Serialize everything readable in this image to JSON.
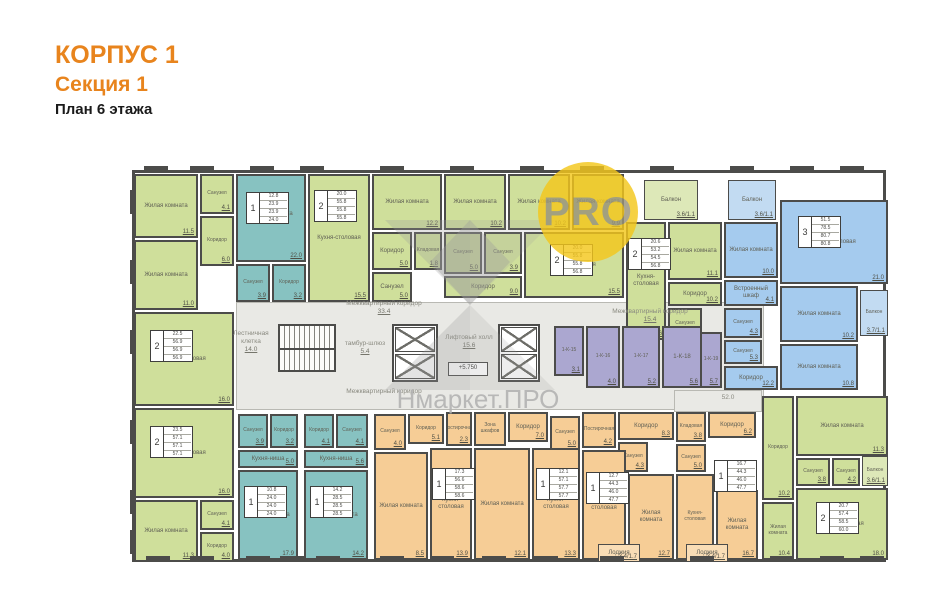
{
  "header": {
    "building": "КОРПУС 1",
    "section": "Секция 1",
    "floor": "План 6 этажа"
  },
  "watermark": {
    "brand": "Нмаркет.ПРО",
    "badge": "PRO"
  },
  "colors": {
    "accent": "#e8841d",
    "wall": "#4c4c4a",
    "green": "#cfdf9b",
    "teal": "#87c2c1",
    "blue": "#a5cbee",
    "orange": "#f6cd96",
    "purple": "#aba7d0",
    "corridor": "#e9e9e5",
    "badge_yellow": "#f4c71c"
  },
  "plan": {
    "corridor_zones": [
      {
        "x": 106,
        "y": 142,
        "w": 528,
        "h": 108
      },
      {
        "x": 544,
        "y": 230,
        "w": 88,
        "h": 22
      }
    ],
    "rooms": [
      {
        "n": "Жилая комната",
        "a": "11.5",
        "c": "g",
        "x": 4,
        "y": 14,
        "w": 64,
        "h": 64
      },
      {
        "n": "Санузел",
        "a": "4.1",
        "c": "g",
        "x": 70,
        "y": 14,
        "w": 34,
        "h": 40
      },
      {
        "n": "Коридор",
        "a": "6.0",
        "c": "g",
        "x": 70,
        "y": 56,
        "w": 34,
        "h": 50
      },
      {
        "n": "Жилая комната",
        "a": "11.0",
        "c": "g",
        "x": 4,
        "y": 80,
        "w": 64,
        "h": 70
      },
      {
        "n": "Кухня-столовая",
        "a": "16.0",
        "c": "g",
        "x": 4,
        "y": 152,
        "w": 100,
        "h": 94
      },
      {
        "n": "Кухня-столовая",
        "a": "16.0",
        "c": "g",
        "x": 4,
        "y": 248,
        "w": 100,
        "h": 90
      },
      {
        "n": "Жилая комната",
        "a": "11.3",
        "c": "g",
        "x": 4,
        "y": 340,
        "w": 64,
        "h": 62
      },
      {
        "n": "Санузел",
        "a": "4.1",
        "c": "g",
        "x": 70,
        "y": 340,
        "w": 34,
        "h": 30
      },
      {
        "n": "Коридор",
        "a": "4.0",
        "c": "g",
        "x": 70,
        "y": 372,
        "w": 34,
        "h": 30
      },
      {
        "n": "Жилая комната",
        "n2": "Кухня-ниша",
        "a": "22.0",
        "c": "t",
        "x": 106,
        "y": 14,
        "w": 70,
        "h": 88
      },
      {
        "n": "Санузел",
        "a": "3.9",
        "c": "t",
        "x": 106,
        "y": 104,
        "w": 34,
        "h": 38
      },
      {
        "n": "Коридор",
        "a": "3.2",
        "c": "t",
        "x": 142,
        "y": 104,
        "w": 34,
        "h": 38
      },
      {
        "n": "Кухня-столовая",
        "a": "15.5",
        "c": "g",
        "x": 178,
        "y": 14,
        "w": 62,
        "h": 128
      },
      {
        "n": "Жилая комната",
        "a": "12.2",
        "c": "g",
        "x": 242,
        "y": 14,
        "w": 70,
        "h": 56
      },
      {
        "n": "Коридор",
        "a": "5.0",
        "c": "g",
        "x": 242,
        "y": 72,
        "w": 40,
        "h": 38
      },
      {
        "n": "Кладовая",
        "a": "1.8",
        "c": "g",
        "x": 284,
        "y": 72,
        "w": 28,
        "h": 38
      },
      {
        "n": "Санузел",
        "a": "5.0",
        "c": "g",
        "x": 242,
        "y": 112,
        "w": 40,
        "h": 30
      },
      {
        "n": "Жилая комната",
        "a": "10.2",
        "c": "g",
        "x": 314,
        "y": 14,
        "w": 62,
        "h": 56
      },
      {
        "n": "Жилая комната",
        "a": "10.2",
        "c": "g",
        "x": 378,
        "y": 14,
        "w": 62,
        "h": 56
      },
      {
        "n": "Жилая комната",
        "a": "9.9",
        "c": "g",
        "x": 442,
        "y": 14,
        "w": 52,
        "h": 56
      },
      {
        "n": "Санузел",
        "a": "5.0",
        "c": "g",
        "x": 314,
        "y": 72,
        "w": 38,
        "h": 42
      },
      {
        "n": "Санузел",
        "a": "3.9",
        "c": "g",
        "x": 354,
        "y": 72,
        "w": 38,
        "h": 42
      },
      {
        "n": "Коридор",
        "a": "9.0",
        "c": "g",
        "x": 314,
        "y": 116,
        "w": 78,
        "h": 22
      },
      {
        "n": "Кухня-столовая",
        "a": "15.5",
        "c": "g",
        "x": 394,
        "y": 72,
        "w": 100,
        "h": 66
      },
      {
        "n": "Балкон",
        "a": "3.6/1.1",
        "c": "gb",
        "x": 514,
        "y": 20,
        "w": 54,
        "h": 40
      },
      {
        "n": "Кухня-столовая",
        "a": "18.6",
        "c": "g",
        "x": 496,
        "y": 62,
        "w": 40,
        "h": 118
      },
      {
        "n": "Жилая комната",
        "a": "11.1",
        "c": "g",
        "x": 538,
        "y": 62,
        "w": 54,
        "h": 58
      },
      {
        "n": "Коридор",
        "a": "10.2",
        "c": "g",
        "x": 538,
        "y": 122,
        "w": 54,
        "h": 24
      },
      {
        "n": "Санузел",
        "a": "4.7",
        "c": "g",
        "x": 538,
        "y": 148,
        "w": 34,
        "h": 32
      },
      {
        "n": "Балкон",
        "a": "3.6/1.1",
        "c": "bb",
        "x": 598,
        "y": 20,
        "w": 48,
        "h": 40
      },
      {
        "n": "Жилая комната",
        "a": "10.0",
        "c": "b",
        "x": 594,
        "y": 62,
        "w": 54,
        "h": 56
      },
      {
        "n": "Кухня-столовая",
        "a": "21.0",
        "c": "b",
        "x": 650,
        "y": 40,
        "w": 108,
        "h": 84
      },
      {
        "n": "Встроенный шкаф",
        "a": "4.1",
        "c": "b",
        "x": 594,
        "y": 120,
        "w": 54,
        "h": 26
      },
      {
        "n": "Санузел",
        "a": "4.3",
        "c": "b",
        "x": 594,
        "y": 148,
        "w": 38,
        "h": 30
      },
      {
        "n": "Санузел",
        "a": "5.3",
        "c": "b",
        "x": 594,
        "y": 180,
        "w": 38,
        "h": 24
      },
      {
        "n": "Коридор",
        "a": "12.2",
        "c": "b",
        "x": 594,
        "y": 206,
        "w": 54,
        "h": 24
      },
      {
        "n": "Жилая комната",
        "a": "10.2",
        "c": "b",
        "x": 650,
        "y": 126,
        "w": 78,
        "h": 56
      },
      {
        "n": "Балкон",
        "a": "3.7/1.1",
        "c": "bb",
        "x": 730,
        "y": 130,
        "w": 28,
        "h": 46
      },
      {
        "n": "Жилая комната",
        "a": "10.8",
        "c": "b",
        "x": 650,
        "y": 184,
        "w": 78,
        "h": 46
      },
      {
        "n": "1-К-15",
        "a": "3.1",
        "c": "p",
        "x": 424,
        "y": 166,
        "w": 30,
        "h": 50
      },
      {
        "n": "1-К-16",
        "a": "4.0",
        "c": "p",
        "x": 456,
        "y": 166,
        "w": 34,
        "h": 62
      },
      {
        "n": "1-К-17",
        "a": "5.2",
        "c": "p",
        "x": 492,
        "y": 166,
        "w": 38,
        "h": 62
      },
      {
        "n": "1-К-18",
        "a": "5.6",
        "c": "p",
        "x": 532,
        "y": 166,
        "w": 40,
        "h": 62
      },
      {
        "n": "1-К-19",
        "a": "5.7",
        "c": "p",
        "x": 570,
        "y": 172,
        "w": 22,
        "h": 56
      },
      {
        "n": "Санузел",
        "a": "3.9",
        "c": "t",
        "x": 108,
        "y": 254,
        "w": 30,
        "h": 34
      },
      {
        "n": "Коридор",
        "a": "3.2",
        "c": "t",
        "x": 140,
        "y": 254,
        "w": 28,
        "h": 34
      },
      {
        "n": "Кухня-ниша",
        "a": "5.0",
        "c": "t",
        "x": 108,
        "y": 290,
        "w": 60,
        "h": 18
      },
      {
        "n": "Жилая комната",
        "a": "17.9",
        "c": "t",
        "x": 108,
        "y": 310,
        "w": 60,
        "h": 90
      },
      {
        "n": "Коридор",
        "a": "4.1",
        "c": "t",
        "x": 174,
        "y": 254,
        "w": 30,
        "h": 34
      },
      {
        "n": "Санузел",
        "a": "4.1",
        "c": "t",
        "x": 206,
        "y": 254,
        "w": 32,
        "h": 34
      },
      {
        "n": "Кухня-ниша",
        "a": "5.6",
        "c": "t",
        "x": 174,
        "y": 290,
        "w": 64,
        "h": 18
      },
      {
        "n": "Жилая комната",
        "a": "14.2",
        "c": "t",
        "x": 174,
        "y": 310,
        "w": 64,
        "h": 90
      },
      {
        "n": "Санузел",
        "a": "4.0",
        "c": "o",
        "x": 244,
        "y": 254,
        "w": 32,
        "h": 36
      },
      {
        "n": "Коридор",
        "a": "5.1",
        "c": "o",
        "x": 278,
        "y": 254,
        "w": 36,
        "h": 30
      },
      {
        "n": "Постирочная",
        "a": "2.3",
        "c": "o",
        "x": 316,
        "y": 252,
        "w": 26,
        "h": 34
      },
      {
        "n": "Жилая комната",
        "a": "8.5",
        "c": "o",
        "x": 244,
        "y": 292,
        "w": 54,
        "h": 108
      },
      {
        "n": "Кухня-столовая",
        "a": "13.9",
        "c": "o",
        "x": 300,
        "y": 288,
        "w": 42,
        "h": 112
      },
      {
        "n": "Зона шкафов",
        "a": "",
        "c": "o",
        "x": 344,
        "y": 252,
        "w": 32,
        "h": 34
      },
      {
        "n": "Коридор",
        "a": "7.0",
        "c": "o",
        "x": 378,
        "y": 252,
        "w": 40,
        "h": 30
      },
      {
        "n": "Санузел",
        "a": "5.0",
        "c": "o",
        "x": 420,
        "y": 256,
        "w": 30,
        "h": 34
      },
      {
        "n": "Жилая комната",
        "a": "12.1",
        "c": "o",
        "x": 344,
        "y": 288,
        "w": 56,
        "h": 112
      },
      {
        "n": "Кухня-столовая",
        "a": "13.3",
        "c": "o",
        "x": 402,
        "y": 288,
        "w": 48,
        "h": 112
      },
      {
        "n": "Постирочная",
        "a": "4.2",
        "c": "o",
        "x": 452,
        "y": 252,
        "w": 34,
        "h": 36
      },
      {
        "n": "Коридор",
        "a": "8.3",
        "c": "o",
        "x": 488,
        "y": 252,
        "w": 56,
        "h": 28
      },
      {
        "n": "Санузел",
        "a": "4.3",
        "c": "o",
        "x": 488,
        "y": 282,
        "w": 30,
        "h": 30
      },
      {
        "n": "Кухня-столовая",
        "a": "16.8",
        "c": "o",
        "x": 452,
        "y": 290,
        "w": 44,
        "h": 110
      },
      {
        "n": "Жилая комната",
        "a": "12.7",
        "c": "o",
        "x": 498,
        "y": 314,
        "w": 46,
        "h": 86
      },
      {
        "n": "Лоджия",
        "a": "3.4/1.7",
        "c": "ob",
        "x": 468,
        "y": 384,
        "w": 42,
        "h": 18
      },
      {
        "n": "Кладовая",
        "a": "3.8",
        "c": "o",
        "x": 546,
        "y": 252,
        "w": 30,
        "h": 30
      },
      {
        "n": "Коридор",
        "a": "6.2",
        "c": "o",
        "x": 578,
        "y": 252,
        "w": 48,
        "h": 26
      },
      {
        "n": "Санузел",
        "a": "5.0",
        "c": "o",
        "x": 546,
        "y": 284,
        "w": 30,
        "h": 28
      },
      {
        "n": "Кухня-столовая",
        "a": "16.8",
        "c": "o",
        "x": 546,
        "y": 314,
        "w": 38,
        "h": 86
      },
      {
        "n": "Жилая комната",
        "a": "16.7",
        "c": "o",
        "x": 586,
        "y": 330,
        "w": 42,
        "h": 70
      },
      {
        "n": "Лоджия",
        "a": "3.4/1.7",
        "c": "ob",
        "x": 556,
        "y": 384,
        "w": 42,
        "h": 18
      },
      {
        "n": "Коридор",
        "a": "10.2",
        "c": "g",
        "x": 632,
        "y": 236,
        "w": 32,
        "h": 104
      },
      {
        "n": "Жилая комната",
        "a": "11.3",
        "c": "g",
        "x": 666,
        "y": 236,
        "w": 92,
        "h": 60
      },
      {
        "n": "Санузел",
        "a": "3.8",
        "c": "g",
        "x": 666,
        "y": 298,
        "w": 34,
        "h": 28
      },
      {
        "n": "Санузел",
        "a": "4.2",
        "c": "g",
        "x": 702,
        "y": 298,
        "w": 28,
        "h": 28
      },
      {
        "n": "Балкон",
        "a": "3.6/1.1",
        "c": "gb",
        "x": 732,
        "y": 296,
        "w": 26,
        "h": 30
      },
      {
        "n": "Жилая комната",
        "a": "10.4",
        "c": "g",
        "x": 632,
        "y": 342,
        "w": 32,
        "h": 58
      },
      {
        "n": "Кухня-столовая",
        "a": "18.0",
        "c": "g",
        "x": 666,
        "y": 328,
        "w": 92,
        "h": 72
      }
    ],
    "stamps": [
      {
        "num": "2",
        "vals": [
          "22.5",
          "56.9",
          "56.9",
          "56.9"
        ],
        "x": 20,
        "y": 170
      },
      {
        "num": "2",
        "vals": [
          "23.5",
          "57.1",
          "57.1",
          "57.1"
        ],
        "x": 20,
        "y": 266
      },
      {
        "num": "1",
        "vals": [
          "12.8",
          "23.9",
          "23.9",
          "24.0"
        ],
        "x": 116,
        "y": 32
      },
      {
        "num": "2",
        "vals": [
          "20.0",
          "55.8",
          "55.8",
          "55.8"
        ],
        "x": 184,
        "y": 30
      },
      {
        "num": "2",
        "vals": [
          "20.0",
          "55.8",
          "55.8",
          "56.8"
        ],
        "x": 420,
        "y": 84
      },
      {
        "num": "2",
        "vals": [
          "20.6",
          "53.2",
          "54.5",
          "56.8"
        ],
        "x": 498,
        "y": 78
      },
      {
        "num": "3",
        "vals": [
          "51.5",
          "78.5",
          "80.7",
          "80.8"
        ],
        "x": 668,
        "y": 56
      },
      {
        "num": "1",
        "vals": [
          "10.8",
          "24.0",
          "24.0",
          "24.0"
        ],
        "x": 114,
        "y": 326
      },
      {
        "num": "1",
        "vals": [
          "14.2",
          "28.5",
          "28.5",
          "28.5"
        ],
        "x": 180,
        "y": 326
      },
      {
        "num": "1",
        "vals": [
          "17.3",
          "56.6",
          "58.6",
          "58.6"
        ],
        "x": 302,
        "y": 308
      },
      {
        "num": "1",
        "vals": [
          "12.1",
          "57.1",
          "57.7",
          "57.7"
        ],
        "x": 406,
        "y": 308
      },
      {
        "num": "1",
        "vals": [
          "12.7",
          "44.3",
          "46.0",
          "47.7"
        ],
        "x": 456,
        "y": 312
      },
      {
        "num": "1",
        "vals": [
          "16.7",
          "44.3",
          "46.0",
          "47.7"
        ],
        "x": 584,
        "y": 300
      },
      {
        "num": "2",
        "vals": [
          "20.7",
          "57.4",
          "58.5",
          "60.0"
        ],
        "x": 686,
        "y": 342
      }
    ],
    "corridor_labels": [
      {
        "t": "Межквартирный коридор",
        "a": "33.4",
        "x": 196,
        "y": 140,
        "w": 116
      },
      {
        "t": "Межквартирный коридор",
        "a": "",
        "x": 196,
        "y": 228,
        "w": 116
      },
      {
        "t": "Межквартирный коридор",
        "a": "15.4",
        "x": 462,
        "y": 148,
        "w": 116
      },
      {
        "t": "тамбур-шлюз",
        "a": "5.4",
        "x": 210,
        "y": 180,
        "w": 50
      },
      {
        "t": "Лестничная клетка",
        "a": "14.0",
        "x": 96,
        "y": 170,
        "w": 50
      },
      {
        "t": "Лифтовый холл",
        "a": "15.6",
        "x": 312,
        "y": 174,
        "w": 54
      },
      {
        "t": "52.0",
        "a": "",
        "x": 578,
        "y": 234,
        "w": 40
      },
      {
        "t": "+5.750",
        "a": "",
        "x": 318,
        "y": 202,
        "w": 38,
        "box": true
      }
    ],
    "stairs": {
      "x": 148,
      "y": 164,
      "w": 58,
      "h": 48
    },
    "elevator_groups": [
      {
        "x": 262,
        "y": 164,
        "w": 46,
        "h": 58
      },
      {
        "x": 368,
        "y": 164,
        "w": 42,
        "h": 58
      }
    ],
    "window_marks": {
      "top_x": [
        14,
        60,
        120,
        170,
        250,
        320,
        390,
        450,
        520,
        600,
        660,
        710
      ],
      "bottom_x": [
        16,
        60,
        116,
        150,
        186,
        250,
        300,
        352,
        404,
        470,
        560,
        640,
        690,
        730
      ],
      "left_y": [
        30,
        100,
        170,
        260,
        330,
        370
      ]
    }
  }
}
